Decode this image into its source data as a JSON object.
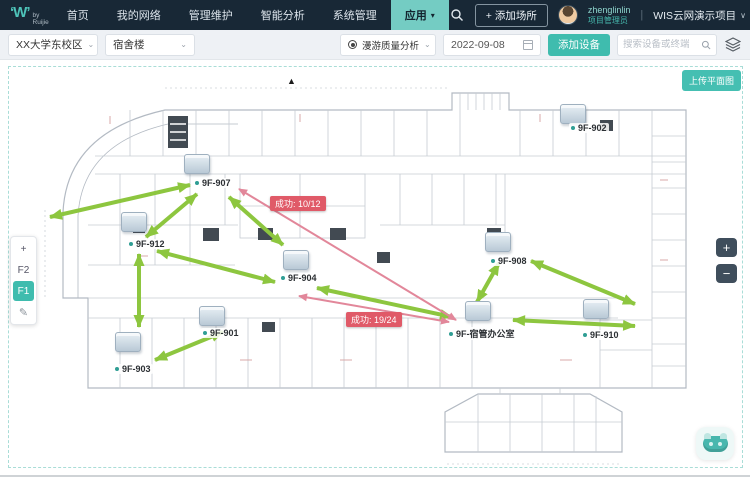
{
  "colors": {
    "accent": "#3fbcae",
    "accent_light": "#74ccc3",
    "arrow_green": "#8dc63f",
    "arrow_pink": "#e2879a",
    "badge_red": "#e05a68",
    "navbar_bg": "#182836"
  },
  "navbar": {
    "logo": {
      "mark": "‘W’",
      "sub": "by Ruijie"
    },
    "items": [
      {
        "label": "首页"
      },
      {
        "label": "我的网络"
      },
      {
        "label": "管理维护"
      },
      {
        "label": "智能分析"
      },
      {
        "label": "系统管理"
      },
      {
        "label": "应用",
        "active": true,
        "caret": "▾"
      }
    ],
    "add_place": "+ 添加场所",
    "user": {
      "name": "zhenglinlin",
      "role": "项目管理员"
    },
    "project_divider": "|",
    "project": "WIS云网演示项目",
    "project_caret": "∨"
  },
  "toolbar": {
    "campus": "XX大学东校区",
    "building": "宿舍楼",
    "analysis": "漫游质量分析",
    "date": "2022-09-08",
    "add_device": "添加设备",
    "search_placeholder": "搜索设备或终端",
    "caret": "⌄"
  },
  "map": {
    "upload": "上传平面图",
    "compass": "▲",
    "floors": {
      "plus": "+",
      "edit": "✎",
      "items": [
        {
          "label": "F2"
        },
        {
          "label": "F1",
          "active": true
        }
      ]
    },
    "zoom": {
      "in": "+",
      "out": "−"
    },
    "aps": [
      {
        "name": "9F-902",
        "icon_x": 560,
        "icon_y": 44,
        "label_x": 569,
        "label_y": 63
      },
      {
        "name": "9F-907",
        "icon_x": 184,
        "icon_y": 94,
        "label_x": 193,
        "label_y": 118
      },
      {
        "name": "9F-912",
        "icon_x": 121,
        "icon_y": 152,
        "label_x": 127,
        "label_y": 179
      },
      {
        "name": "9F-904",
        "icon_x": 283,
        "icon_y": 190,
        "label_x": 279,
        "label_y": 213
      },
      {
        "name": "9F-908",
        "icon_x": 485,
        "icon_y": 172,
        "label_x": 489,
        "label_y": 196
      },
      {
        "name": "9F-901",
        "icon_x": 199,
        "icon_y": 246,
        "label_x": 201,
        "label_y": 268
      },
      {
        "name": "9F-903",
        "icon_x": 115,
        "icon_y": 272,
        "label_x": 113,
        "label_y": 304
      },
      {
        "name": "9F-910",
        "icon_x": 583,
        "icon_y": 239,
        "label_x": 581,
        "label_y": 270
      },
      {
        "name": "9F-宿管办公室",
        "icon_x": 465,
        "icon_y": 241,
        "label_x": 447,
        "label_y": 267
      }
    ],
    "badges": [
      {
        "text": "成功: 10/12",
        "x": 270,
        "y": 136
      },
      {
        "text": "成功: 19/24",
        "x": 346,
        "y": 252
      }
    ],
    "arrows": [
      {
        "x1": 50,
        "y1": 157,
        "x2": 190,
        "y2": 125,
        "color": "green",
        "double": true
      },
      {
        "x1": 146,
        "y1": 177,
        "x2": 197,
        "y2": 134,
        "color": "green",
        "double": true
      },
      {
        "x1": 229,
        "y1": 137,
        "x2": 283,
        "y2": 185,
        "color": "green",
        "double": true
      },
      {
        "x1": 157,
        "y1": 191,
        "x2": 275,
        "y2": 222,
        "color": "green",
        "double": true
      },
      {
        "x1": 139,
        "y1": 194,
        "x2": 139,
        "y2": 267,
        "color": "green",
        "double": true
      },
      {
        "x1": 155,
        "y1": 300,
        "x2": 223,
        "y2": 272,
        "color": "green",
        "double": true
      },
      {
        "x1": 317,
        "y1": 228,
        "x2": 452,
        "y2": 257,
        "color": "green",
        "double": true
      },
      {
        "x1": 499,
        "y1": 203,
        "x2": 477,
        "y2": 242,
        "color": "green",
        "double": true
      },
      {
        "x1": 531,
        "y1": 201,
        "x2": 635,
        "y2": 244,
        "color": "green",
        "double": true
      },
      {
        "x1": 513,
        "y1": 260,
        "x2": 635,
        "y2": 266,
        "color": "green",
        "double": true
      },
      {
        "x1": 239,
        "y1": 129,
        "x2": 456,
        "y2": 260,
        "color": "pink",
        "double": true
      },
      {
        "x1": 299,
        "y1": 236,
        "x2": 449,
        "y2": 262,
        "color": "pink",
        "double": true
      }
    ]
  }
}
